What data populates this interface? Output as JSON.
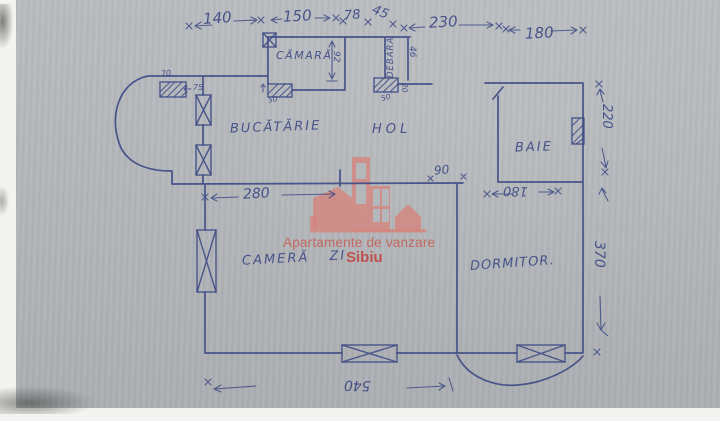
{
  "colors": {
    "ink": "#3e4b85",
    "paper": "#b4b7bb",
    "wm": "#d5857d",
    "wmtext": "#c75b51",
    "wmaccent": "#c33a34"
  },
  "watermark": {
    "line1": "Apartamente de vanzare",
    "line2": "Sibiu"
  },
  "rooms": {
    "camara": "CĂMARĂ",
    "debara": "DEBARA",
    "bucatarie": "BUCĂTĂRIE",
    "hol": "HOL",
    "baie": "BAIE",
    "camera_zi": "CAMERĂ  ZI",
    "dormitor": "DORMITOR."
  },
  "dims": {
    "top_140": "140",
    "top_150": "150",
    "top_78": "78",
    "top_45": "45",
    "top_230": "230",
    "top_180": "180",
    "kitchen_280": "280",
    "door_90": "90",
    "baie_180": "180",
    "bottom_540": "540",
    "right_220": "220",
    "right_370": "370",
    "camara_92": "92",
    "debara_46": "46",
    "camara_door_50": "50",
    "debara_door_50": "50",
    "debara_20": "20",
    "balcony_70": "70",
    "balcony_75": "75"
  }
}
